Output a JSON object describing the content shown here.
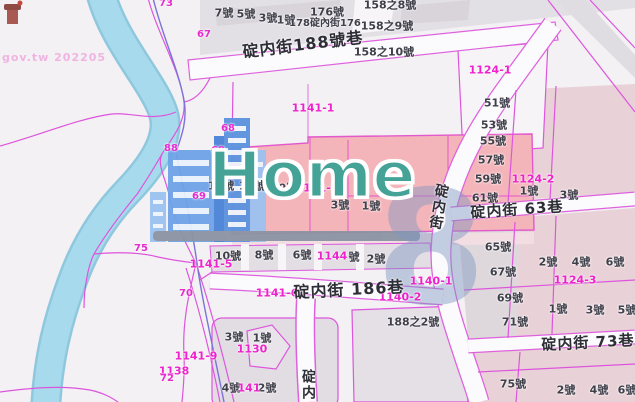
{
  "watermark": {
    "attribution": "gov.tw 202205",
    "brand": "Home",
    "numeral": "8"
  },
  "colors": {
    "parcel_line": "#dd55dd",
    "parcel_label": "#ee22cc",
    "river": "#a6daec",
    "highlight_parcel": "#f4b5ba",
    "building_pink": "#e9d2d7",
    "building_gray": "#e2dee3",
    "road_white": "#fbfafc",
    "brand_teal": "#44a296",
    "skyline_blue": "#5e97e3"
  },
  "map_labels": {
    "street_names": [
      {
        "t": "碇内街188號巷",
        "x": 303,
        "y": 45,
        "r": -7,
        "s": 16
      },
      {
        "t": "碇内街 63巷",
        "x": 517,
        "y": 210,
        "r": -4,
        "s": 15
      },
      {
        "t": "碇内街 73巷",
        "x": 588,
        "y": 343,
        "r": -3,
        "s": 15
      },
      {
        "t": "碇内街 186巷",
        "x": 349,
        "y": 290,
        "r": -3,
        "s": 16
      },
      {
        "t": "碇内街",
        "x": 438,
        "y": 207,
        "r": 10,
        "s": 14,
        "v": true
      },
      {
        "t": "碇内",
        "x": 308,
        "y": 385,
        "r": 0,
        "s": 14,
        "v": true
      }
    ],
    "house_numbers": [
      {
        "t": "7號",
        "x": 224,
        "y": 13
      },
      {
        "t": "5號",
        "x": 246,
        "y": 14
      },
      {
        "t": "3號",
        "x": 268,
        "y": 18
      },
      {
        "t": "1號",
        "x": 286,
        "y": 20
      },
      {
        "t": "176號",
        "x": 327,
        "y": 12
      },
      {
        "t": "178碇內街176",
        "x": 325,
        "y": 24,
        "s": 10
      },
      {
        "t": "158之8號",
        "x": 390,
        "y": 5
      },
      {
        "t": "158之9號",
        "x": 387,
        "y": 26
      },
      {
        "t": "158之10號",
        "x": 384,
        "y": 52
      },
      {
        "t": "15號",
        "x": 221,
        "y": 186
      },
      {
        "t": "11號",
        "x": 252,
        "y": 186
      },
      {
        "t": "9號",
        "x": 288,
        "y": 188
      },
      {
        "t": "3號",
        "x": 340,
        "y": 205
      },
      {
        "t": "1號",
        "x": 371,
        "y": 206
      },
      {
        "t": "51號",
        "x": 497,
        "y": 103
      },
      {
        "t": "53號",
        "x": 494,
        "y": 125
      },
      {
        "t": "55號",
        "x": 493,
        "y": 141
      },
      {
        "t": "57號",
        "x": 491,
        "y": 160
      },
      {
        "t": "59號",
        "x": 488,
        "y": 179
      },
      {
        "t": "61號",
        "x": 485,
        "y": 198
      },
      {
        "t": "1號",
        "x": 529,
        "y": 191
      },
      {
        "t": "3號",
        "x": 569,
        "y": 195
      },
      {
        "t": "65號",
        "x": 498,
        "y": 247
      },
      {
        "t": "67號",
        "x": 503,
        "y": 272
      },
      {
        "t": "69號",
        "x": 510,
        "y": 298
      },
      {
        "t": "71號",
        "x": 515,
        "y": 322
      },
      {
        "t": "2號",
        "x": 548,
        "y": 262
      },
      {
        "t": "4號",
        "x": 581,
        "y": 262
      },
      {
        "t": "6號",
        "x": 615,
        "y": 262
      },
      {
        "t": "1號",
        "x": 558,
        "y": 309
      },
      {
        "t": "3號",
        "x": 595,
        "y": 310
      },
      {
        "t": "5號",
        "x": 627,
        "y": 310
      },
      {
        "t": "75號",
        "x": 513,
        "y": 384
      },
      {
        "t": "2號",
        "x": 566,
        "y": 390
      },
      {
        "t": "4號",
        "x": 599,
        "y": 390
      },
      {
        "t": "6號",
        "x": 627,
        "y": 390
      },
      {
        "t": "10號",
        "x": 228,
        "y": 256
      },
      {
        "t": "8號",
        "x": 264,
        "y": 255
      },
      {
        "t": "6號",
        "x": 302,
        "y": 255
      },
      {
        "t": "號",
        "x": 354,
        "y": 257
      },
      {
        "t": "2號",
        "x": 376,
        "y": 259
      },
      {
        "t": "188之2號",
        "x": 413,
        "y": 322
      },
      {
        "t": "3號",
        "x": 234,
        "y": 337
      },
      {
        "t": "1號",
        "x": 262,
        "y": 338
      },
      {
        "t": "4號",
        "x": 231,
        "y": 388
      },
      {
        "t": "2號",
        "x": 267,
        "y": 388
      }
    ],
    "parcel_numbers": [
      {
        "t": "1141-1",
        "x": 313,
        "y": 108
      },
      {
        "t": "1141-2",
        "x": 317,
        "y": 188
      },
      {
        "t": "1141-5",
        "x": 211,
        "y": 264
      },
      {
        "t": "1141-6",
        "x": 277,
        "y": 293
      },
      {
        "t": "1141-9",
        "x": 196,
        "y": 356
      },
      {
        "t": "1138",
        "x": 174,
        "y": 371
      },
      {
        "t": "1130",
        "x": 252,
        "y": 349
      },
      {
        "t": "1144",
        "x": 332,
        "y": 256
      },
      {
        "t": "141",
        "x": 249,
        "y": 388
      },
      {
        "t": "1140-1",
        "x": 431,
        "y": 281
      },
      {
        "t": "1140-2",
        "x": 400,
        "y": 297
      },
      {
        "t": "1124-1",
        "x": 490,
        "y": 70
      },
      {
        "t": "1124-2",
        "x": 533,
        "y": 179
      },
      {
        "t": "1124-3",
        "x": 575,
        "y": 280
      }
    ],
    "road_numbers": [
      {
        "t": "73",
        "x": 166,
        "y": 4
      },
      {
        "t": "67",
        "x": 204,
        "y": 35
      },
      {
        "t": "88",
        "x": 171,
        "y": 149
      },
      {
        "t": "68",
        "x": 228,
        "y": 129
      },
      {
        "t": "69",
        "x": 218,
        "y": 151
      },
      {
        "t": "69",
        "x": 199,
        "y": 197
      },
      {
        "t": "75",
        "x": 141,
        "y": 249
      },
      {
        "t": "70",
        "x": 186,
        "y": 294
      },
      {
        "t": "72",
        "x": 167,
        "y": 379
      }
    ]
  }
}
